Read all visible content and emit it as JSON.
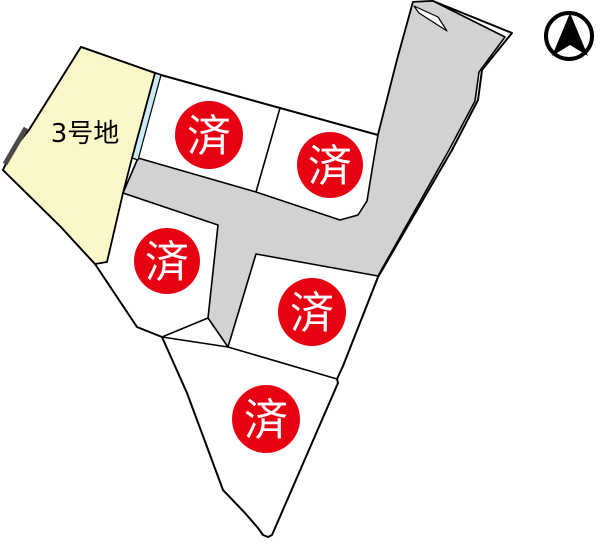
{
  "map": {
    "title": "land-subdivision-plot-map",
    "available_plot": {
      "label": "3号地",
      "status": "available"
    },
    "sold_label": "済",
    "sold_count": 5,
    "colors": {
      "available_fill": "#FAF8C8",
      "road_fill": "#D2D2D2",
      "sold_red": "#E60012",
      "strip_cyan": "#C9ECF4",
      "outline": "#000000",
      "background": "#FFFFFF"
    },
    "icons": {
      "north": "north-compass-arrow"
    }
  }
}
